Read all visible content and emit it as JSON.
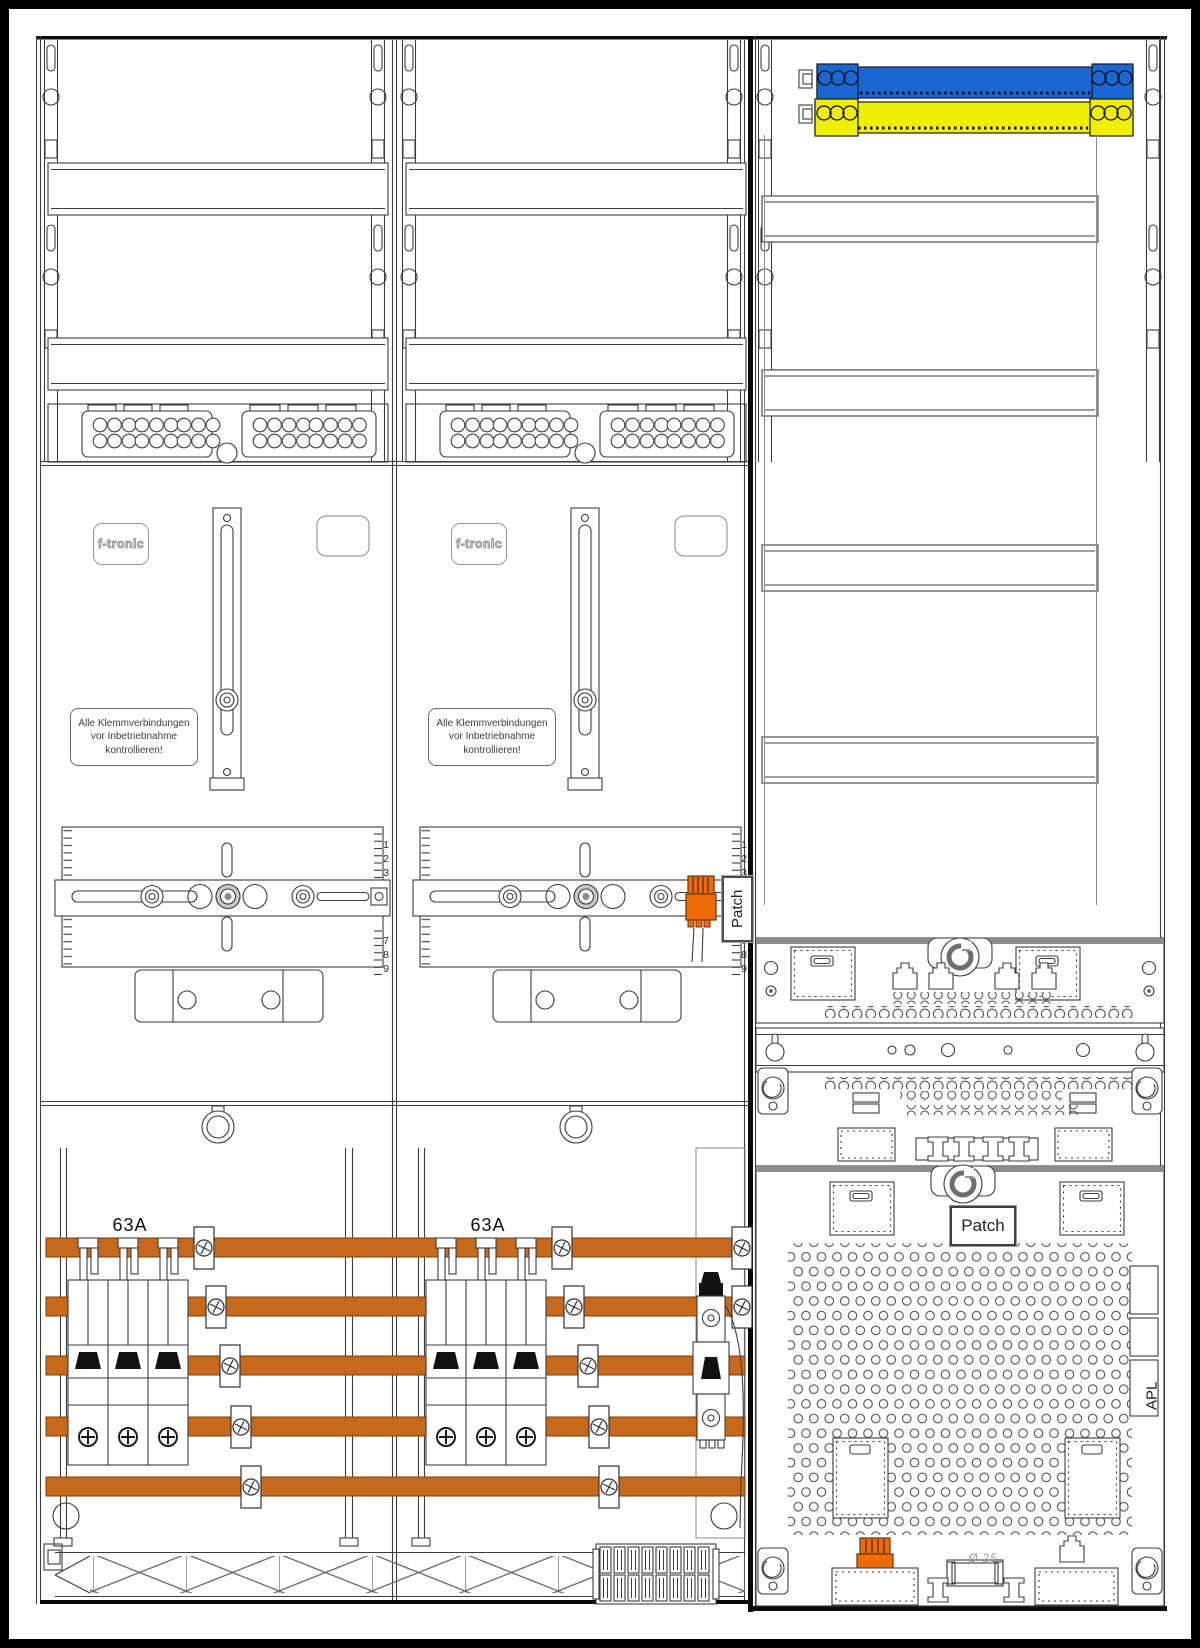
{
  "meter_fields": [
    {
      "brand": "f-tronic",
      "warning": [
        "Alle Klemmverbindungen",
        "vor Inbetriebnahme",
        "kontrollieren!"
      ],
      "rating": "63A",
      "ruler_top": [
        "1",
        "2",
        "3"
      ],
      "ruler_bottom": [
        "7",
        "8",
        "9"
      ]
    },
    {
      "brand": "f-tronic",
      "warning": [
        "Alle Klemmverbindungen",
        "vor Inbetriebnahme",
        "kontrollieren!"
      ],
      "rating": "63A",
      "ruler_top": [
        "1",
        "2",
        "3"
      ],
      "ruler_bottom": [
        "7",
        "8",
        "9"
      ],
      "patch_label": "Patch"
    }
  ],
  "right_column": {
    "patch_label": "Patch",
    "apl_label": "APL",
    "knockout_label": "Ø 25"
  },
  "colors": {
    "neutral_bar_blue": "#1a67d2",
    "pe_bar_yellow": "#f0ee00",
    "busbar_orange": "#c7691a",
    "device_orange": "#ee6b0a"
  }
}
